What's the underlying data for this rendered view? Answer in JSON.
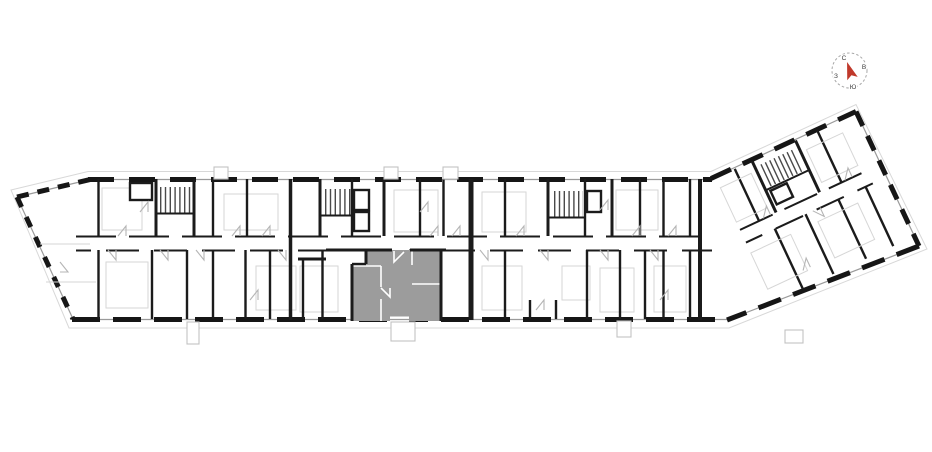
{
  "app": {
    "name": "floor-plan-view",
    "background": "#ffffff"
  },
  "compass": {
    "labels": {
      "north": "С",
      "east": "В",
      "south": "Ю",
      "west": "З"
    },
    "north_color": "#c0392b",
    "letter_color": "#3a3a3a",
    "ring_color": "#a8a8a8",
    "arrow_color": "#c0392b",
    "rotation_deg": -18
  },
  "plan": {
    "selected_unit": {
      "highlighted": true,
      "fill": "#9c9c9c"
    },
    "colors": {
      "wall": "#1b1b1b",
      "window": "#9a9a9a",
      "outline": "#d8d8d8",
      "door": "#b5b5b5",
      "faint": "#d6d6d6",
      "stair_hatch": "#4a4a4a",
      "partition_white": "#ffffff"
    }
  }
}
